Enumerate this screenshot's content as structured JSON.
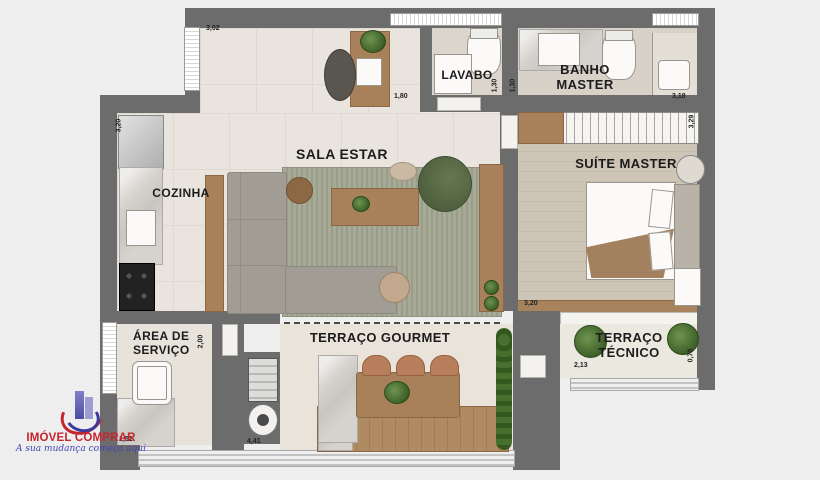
{
  "plan": {
    "rooms": {
      "cozinha": {
        "label": "COZINHA",
        "dim_height": "3,20"
      },
      "sala_estar": {
        "label": "SALA ESTAR",
        "dim_top": "3,02"
      },
      "lavabo": {
        "label": "LAVABO",
        "dim_width": "1,80",
        "dim_height": "1,30"
      },
      "banho_master": {
        "label_line1": "BANHO",
        "label_line2": "MASTER",
        "dim_width": "3,18",
        "dim_height": "1,30"
      },
      "suite_master": {
        "label": "SUÍTE MASTER",
        "dim_width": "3,20",
        "dim_height": "3,29"
      },
      "area_servico": {
        "label_line1": "ÁREA DE",
        "label_line2": "SERVIÇO",
        "dim_height": "2,00",
        "dim_width": "1,52"
      },
      "terraco_gourmet": {
        "label": "TERRAÇO GOURMET",
        "dim_width": "4,41"
      },
      "terraco_tecnico": {
        "label_line1": "TERRAÇO",
        "label_line2": "TÉCNICO",
        "dim_width": "2,13",
        "dim_height": "0,70"
      }
    },
    "colors": {
      "wall": "#6c6c6c",
      "floor_tile": "#e9e5de",
      "wood": "#a8815a",
      "rug_green": "#a6aa96",
      "armchair_green": "#5c6d4a"
    }
  },
  "logo": {
    "title": "IMÓVEL COMPRAR",
    "tagline": "A sua mudança começa aqui",
    "title_color": "#c5252c",
    "tagline_color": "#4444b4"
  }
}
